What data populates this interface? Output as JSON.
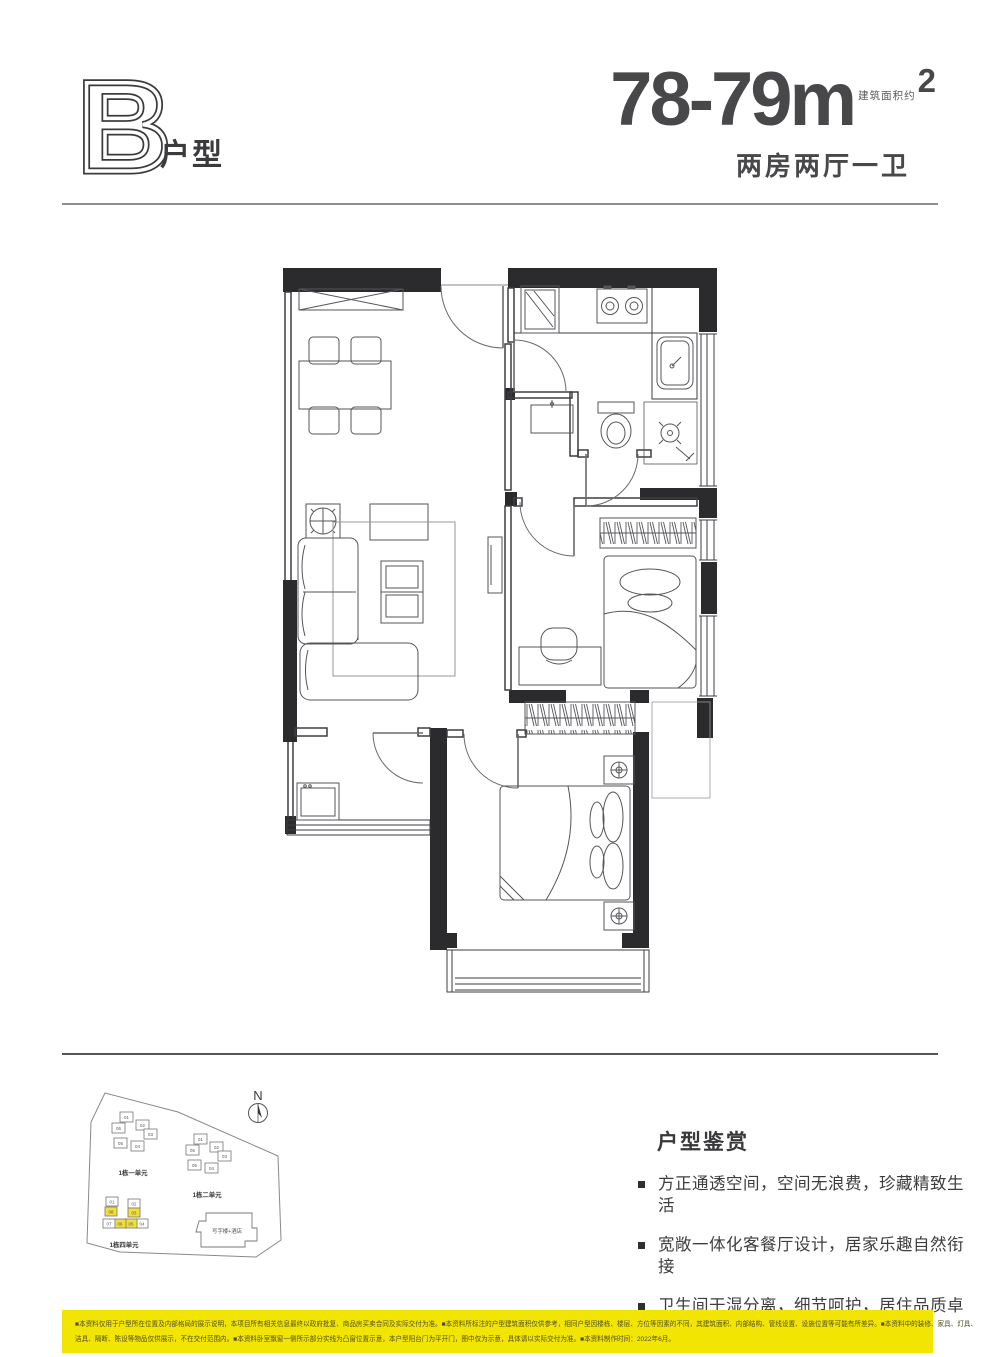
{
  "header": {
    "type_letter": "B",
    "type_label": "户型",
    "area_note": "建筑面积约",
    "area_value": "78-79m",
    "area_sup": "2",
    "rooms_desc": "两房两厅一卫"
  },
  "appreciation": {
    "title": "户型鉴赏",
    "bullets": [
      "方正通透空间，空间无浪费，珍藏精致生活",
      "宽敞一体化客餐厅设计，居家乐趣自然衔接",
      "卫生间干湿分离，细节呵护，居住品质卓越",
      "卧室双面采光，自然光随意入室，生活快意无限"
    ]
  },
  "site_plan": {
    "north_label": "N",
    "hotel_label": "写字楼+酒店",
    "highlight_color": "#F3DF3B",
    "clusters": [
      {
        "name": "1栋一单元",
        "units": [
          {
            "label": "01",
            "highlight": false
          },
          {
            "label": "02",
            "highlight": false
          },
          {
            "label": "03",
            "highlight": false
          },
          {
            "label": "04",
            "highlight": false
          },
          {
            "label": "05",
            "highlight": false
          },
          {
            "label": "06",
            "highlight": false
          }
        ]
      },
      {
        "name": "1栋二单元",
        "units": [
          {
            "label": "01",
            "highlight": false
          },
          {
            "label": "02",
            "highlight": false
          },
          {
            "label": "03",
            "highlight": false
          },
          {
            "label": "04",
            "highlight": false
          },
          {
            "label": "05",
            "highlight": false
          },
          {
            "label": "06",
            "highlight": false
          }
        ]
      },
      {
        "name": "1栋四单元",
        "units": [
          {
            "label": "01",
            "highlight": false
          },
          {
            "label": "02",
            "highlight": false
          },
          {
            "label": "03",
            "highlight": true
          },
          {
            "label": "04",
            "highlight": false
          },
          {
            "label": "05",
            "highlight": true
          },
          {
            "label": "06",
            "highlight": true
          },
          {
            "label": "07",
            "highlight": false
          },
          {
            "label": "08",
            "highlight": true
          }
        ]
      }
    ]
  },
  "disclaimer": {
    "bg_color": "#F2E503",
    "lines": [
      "■本资料仅用于户型所在位置及内部格局的展示说明，本项目所有相关信息最终以政府批复、商品房买卖合同及实际交付为准。■本资料所标注的户型建筑面积仅供参考，相同户型因楼栋、楼层、方位等因素的不同，其建筑面积、内部结构、管线设置、设施位置等可能有所差异。■本资料中的装修、家具、灯具、",
      "洁具、隔断、陈设等物品仅供展示，不在交付范围内。■本资料卧室飘窗一侧所示部分实线为凸窗位置示意，本户型阳台门为平开门，图中仅为示意，具体请以实际交付为准。■本资料制作时间：2022年6月。"
    ]
  }
}
